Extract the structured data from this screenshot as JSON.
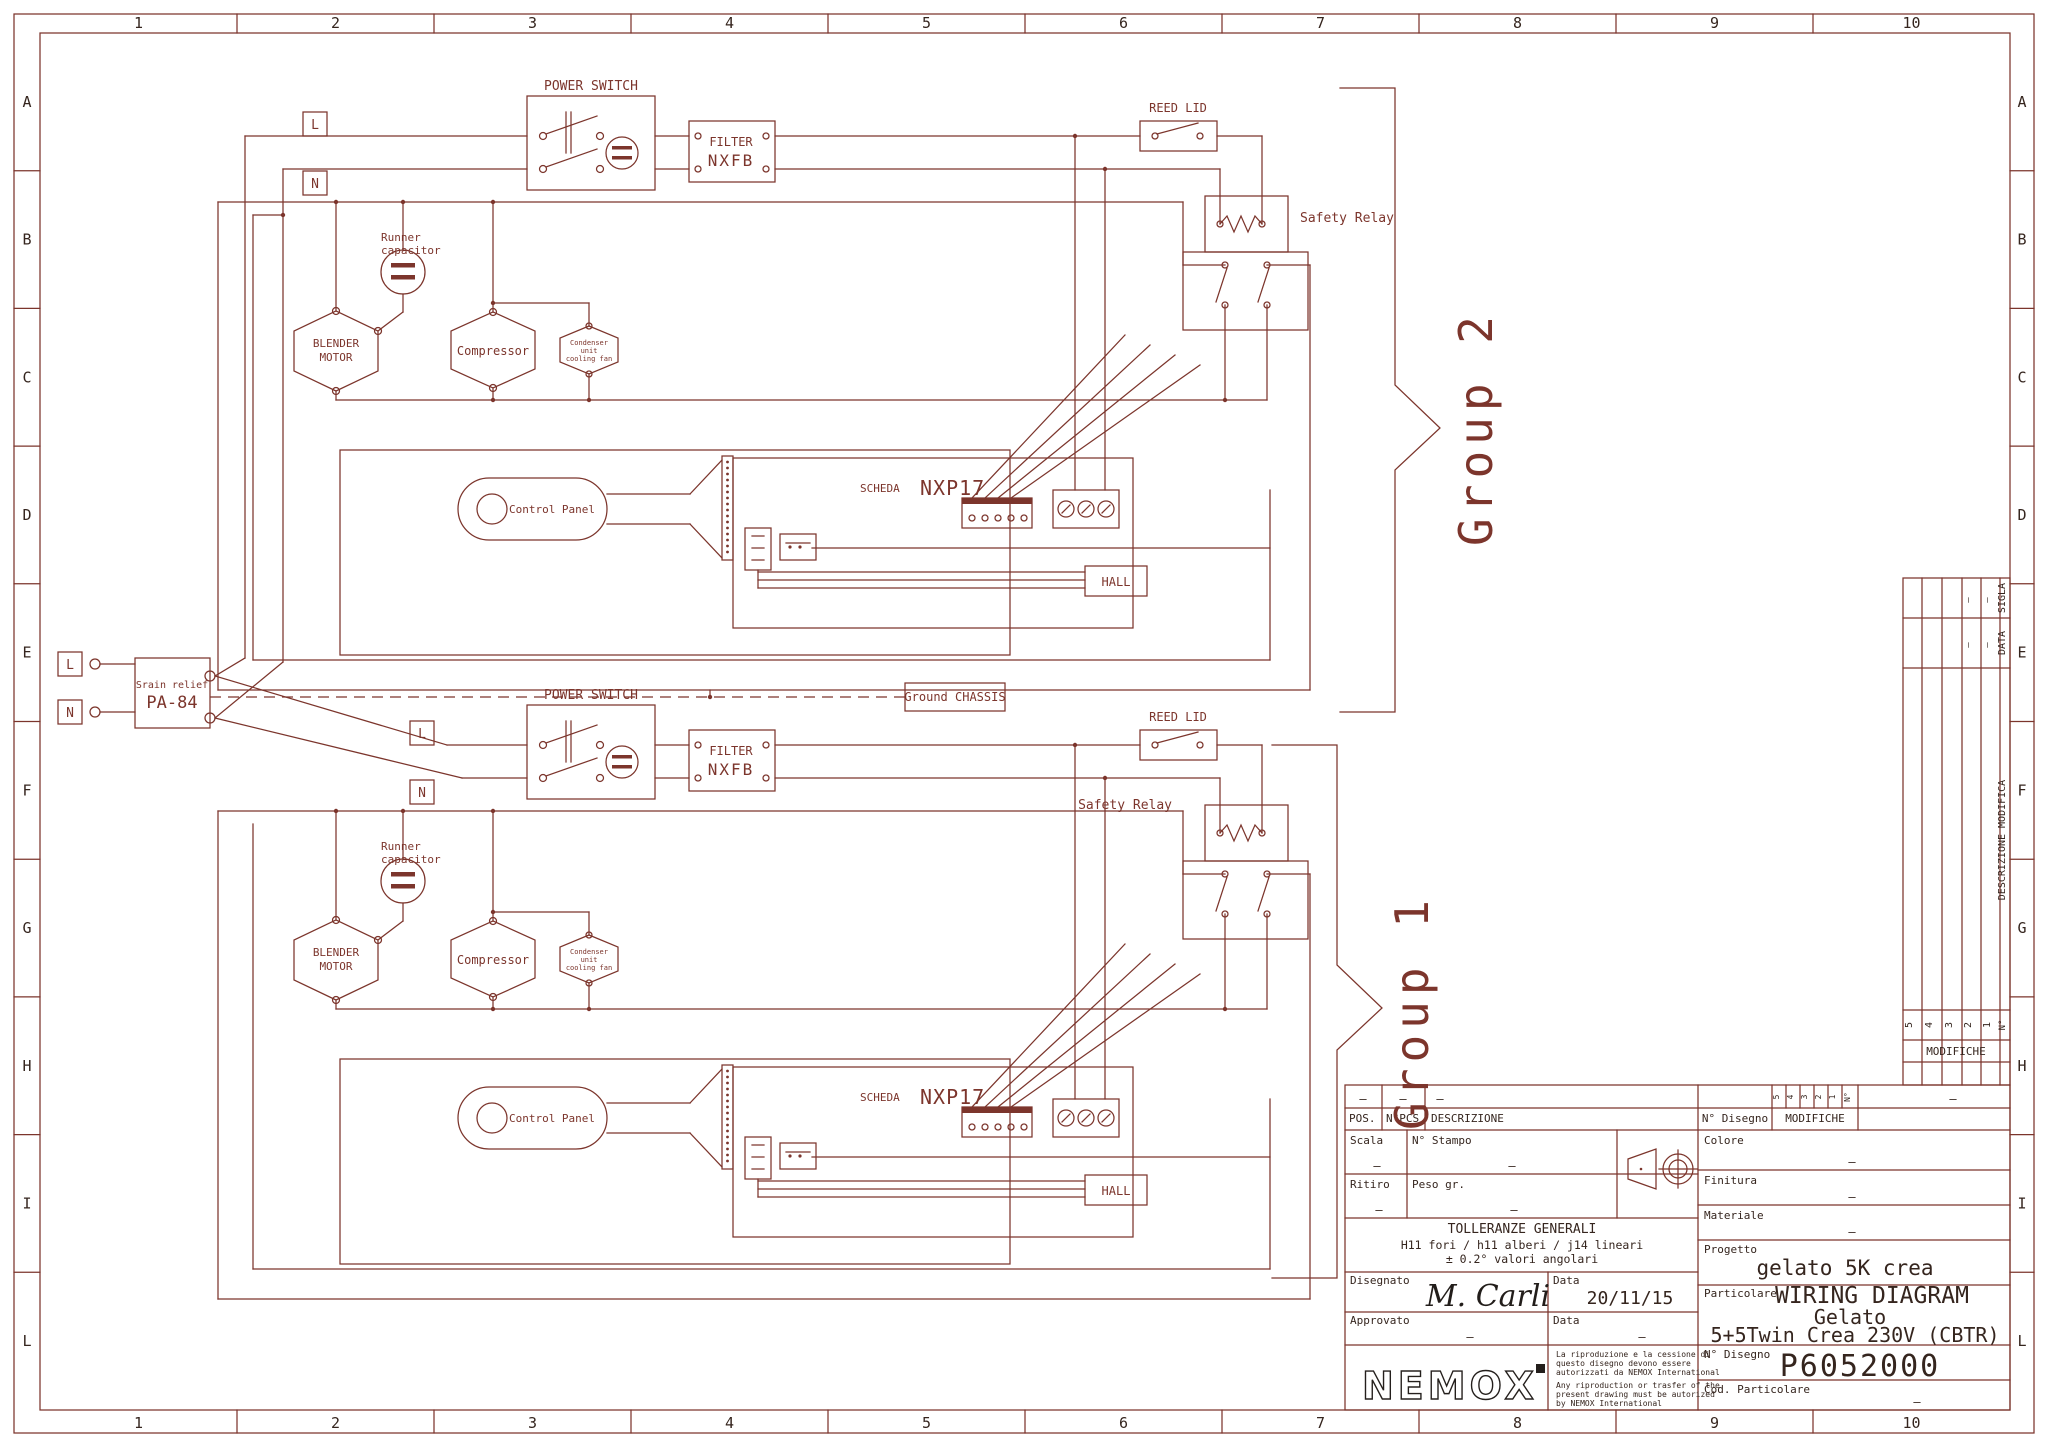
{
  "colors": {
    "line": "#7c352c",
    "title_text": "#35251e",
    "background": "#ffffff"
  },
  "border": {
    "columns": [
      "1",
      "2",
      "3",
      "4",
      "5",
      "6",
      "7",
      "8",
      "9",
      "10"
    ],
    "rows": [
      "A",
      "B",
      "C",
      "D",
      "E",
      "F",
      "G",
      "H",
      "I",
      "L"
    ]
  },
  "groups": [
    {
      "label": "Group 2"
    },
    {
      "label": "Group 1"
    }
  ],
  "components": {
    "l": "L",
    "n": "N",
    "power_switch": "POWER SWITCH",
    "filter_line1": "FILTER",
    "filter_line2": "NXFB",
    "reed_lid": "REED LID",
    "safety_relay": "Safety Relay",
    "runner_capacitor_line1": "Runner",
    "runner_capacitor_line2": "capacitor",
    "blender_motor_line1": "BLENDER",
    "blender_motor_line2": "MOTOR",
    "compressor": "Compressor",
    "condenser_line1": "Condenser",
    "condenser_line2": "unit",
    "condenser_line3": "cooling fan",
    "control_panel": "Control Panel",
    "scheda": "SCHEDA",
    "scheda_model": "NXP17",
    "hall": "HALL"
  },
  "power_input": {
    "l": "L",
    "n": "N",
    "strain_relief_line1": "Srain relief",
    "strain_relief_line2": "PA-84",
    "ground_chassis": "Ground CHASSIS"
  },
  "revision_table": {
    "modifiche": "MODIFICHE",
    "number_header": "N°",
    "columns": [
      "5",
      "4",
      "3",
      "2",
      "1"
    ],
    "sigla": "SIGLA",
    "data": "DATA",
    "descrizione_modifica": "DESCRIZIONE MODIFICA",
    "dash": "—"
  },
  "title_block": {
    "pos": "POS.",
    "npcs": "N°PCS",
    "descrizione": "DESCRIZIONE",
    "n_disegno": "N° Disegno",
    "modifiche": "MODIFICHE",
    "scala": "Scala",
    "n_stampo": "N° Stampo",
    "ritiro": "Ritiro",
    "peso_gr": "Peso gr.",
    "colore": "Colore",
    "finitura": "Finitura",
    "materiale": "Materiale",
    "progetto": "Progetto",
    "progetto_value": "gelato 5K crea",
    "particolare": "Particolare",
    "particolare_value_line1": "WIRING DIAGRAM",
    "particolare_value_line2": "Gelato",
    "particolare_value_line3": "5+5Twin Crea 230V (CBTR)",
    "n_disegno_value": "P6052000",
    "cod_particolare": "Cod. Particolare",
    "tolleranze_line1": "TOLLERANZE GENERALI",
    "tolleranze_line2": "H11 fori / h11 alberi / j14 lineari",
    "tolleranze_line3": "± 0.2° valori angolari",
    "disegnato": "Disegnato",
    "disegnato_value": "M. Carli",
    "data": "Data",
    "data_value": "20/11/15",
    "approvato": "Approvato",
    "logo": "NEMOX",
    "disclaimer_it": [
      "La riproduzione e la cessione di",
      "questo disegno devono essere",
      "autorizzati da NEMOX International"
    ],
    "disclaimer_en": [
      "Any riproduction or trasfer of the",
      "present drawing must be autorized",
      "by NEMOX International"
    ],
    "dash": "—"
  }
}
